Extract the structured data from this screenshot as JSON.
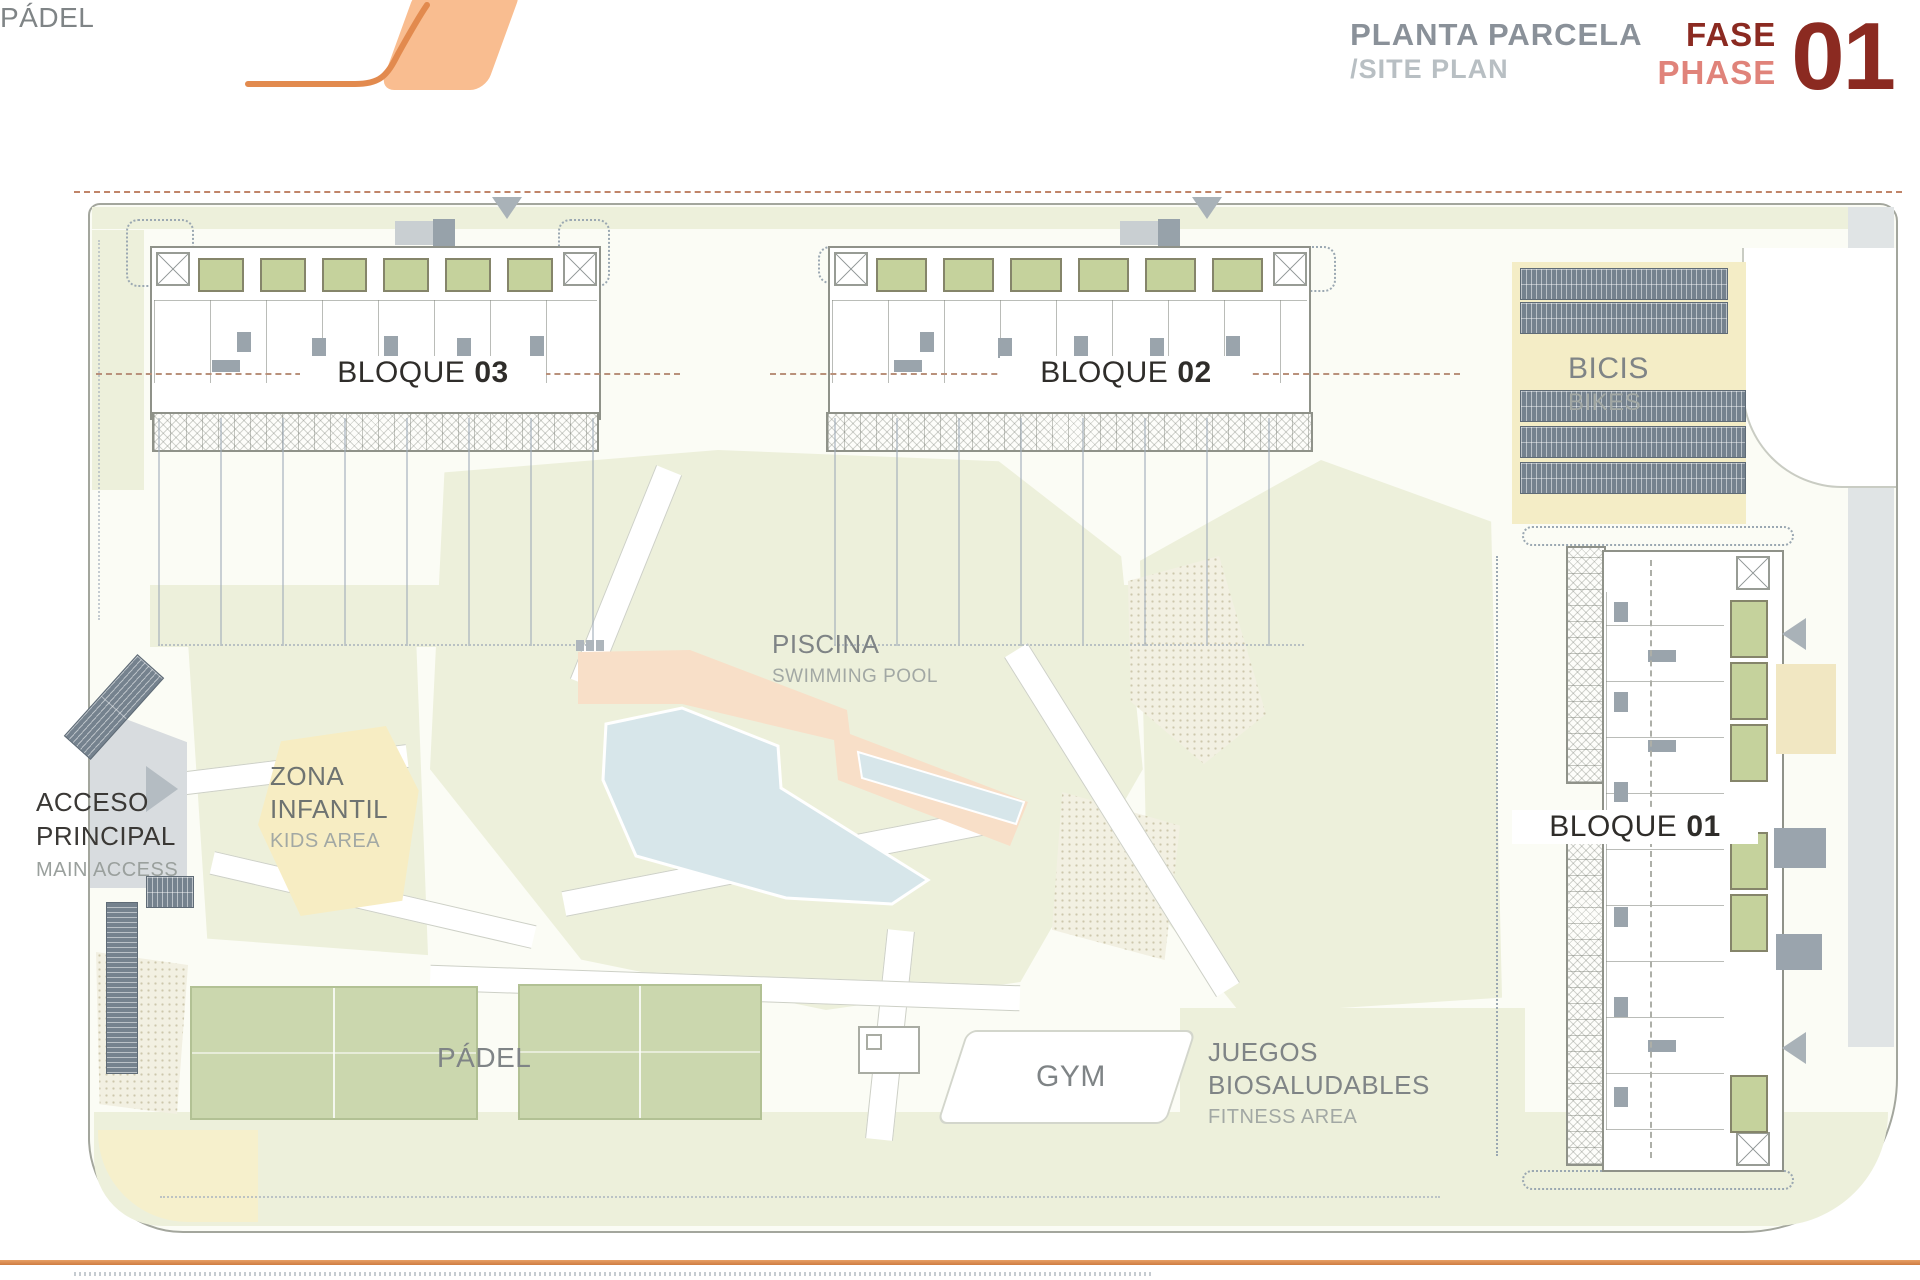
{
  "header": {
    "title_es": "PLANTA PARCELA",
    "title_en": "/SITE PLAN",
    "phase_label_es": "FASE",
    "phase_label_en": "PHASE",
    "phase_number": "01"
  },
  "plan": {
    "blocks": [
      {
        "label": "BLOQUE",
        "number": "03"
      },
      {
        "label": "BLOQUE",
        "number": "02"
      },
      {
        "label": "BLOQUE",
        "number": "01"
      }
    ],
    "areas": {
      "piscina": {
        "name_es": "PISCINA",
        "name_en": "SWIMMING POOL"
      },
      "zona_infantil": {
        "name_es": "ZONA INFANTIL",
        "name_en": "KIDS AREA"
      },
      "acceso_principal": {
        "name_es": "ACCESO PRINCIPAL",
        "name_en": "MAIN ACCESS"
      },
      "padel": {
        "name_es": "PÁDEL"
      },
      "gym": {
        "name_es": "GYM"
      },
      "juegos_biosaludables": {
        "name_es": "JUEGOS BIOSALUDABLES",
        "name_en": "FITNESS AREA"
      },
      "bicis": {
        "name_es": "BICIS",
        "name_en": "BIKES"
      }
    }
  },
  "colors": {
    "accent_orange": "#E28A4E",
    "logo_fill": "#F9BD90",
    "phase_dark_red": "#8B2A21",
    "phase_light_red": "#E0837A",
    "title_gray": "#8A9199",
    "subtitle_gray": "#B8BFC3",
    "lawn_green": "#EDF0DB",
    "terrace_green": "#C5D29C",
    "pool_water": "#D7E6EA",
    "pool_deck": "#F8DFC8",
    "padel_court": "#CBD7AE",
    "kids_yellow": "#F7EDC3",
    "bike_rack_slate": "#75828E",
    "label_dark": "#3A3835",
    "label_gray": "#7F8486"
  }
}
